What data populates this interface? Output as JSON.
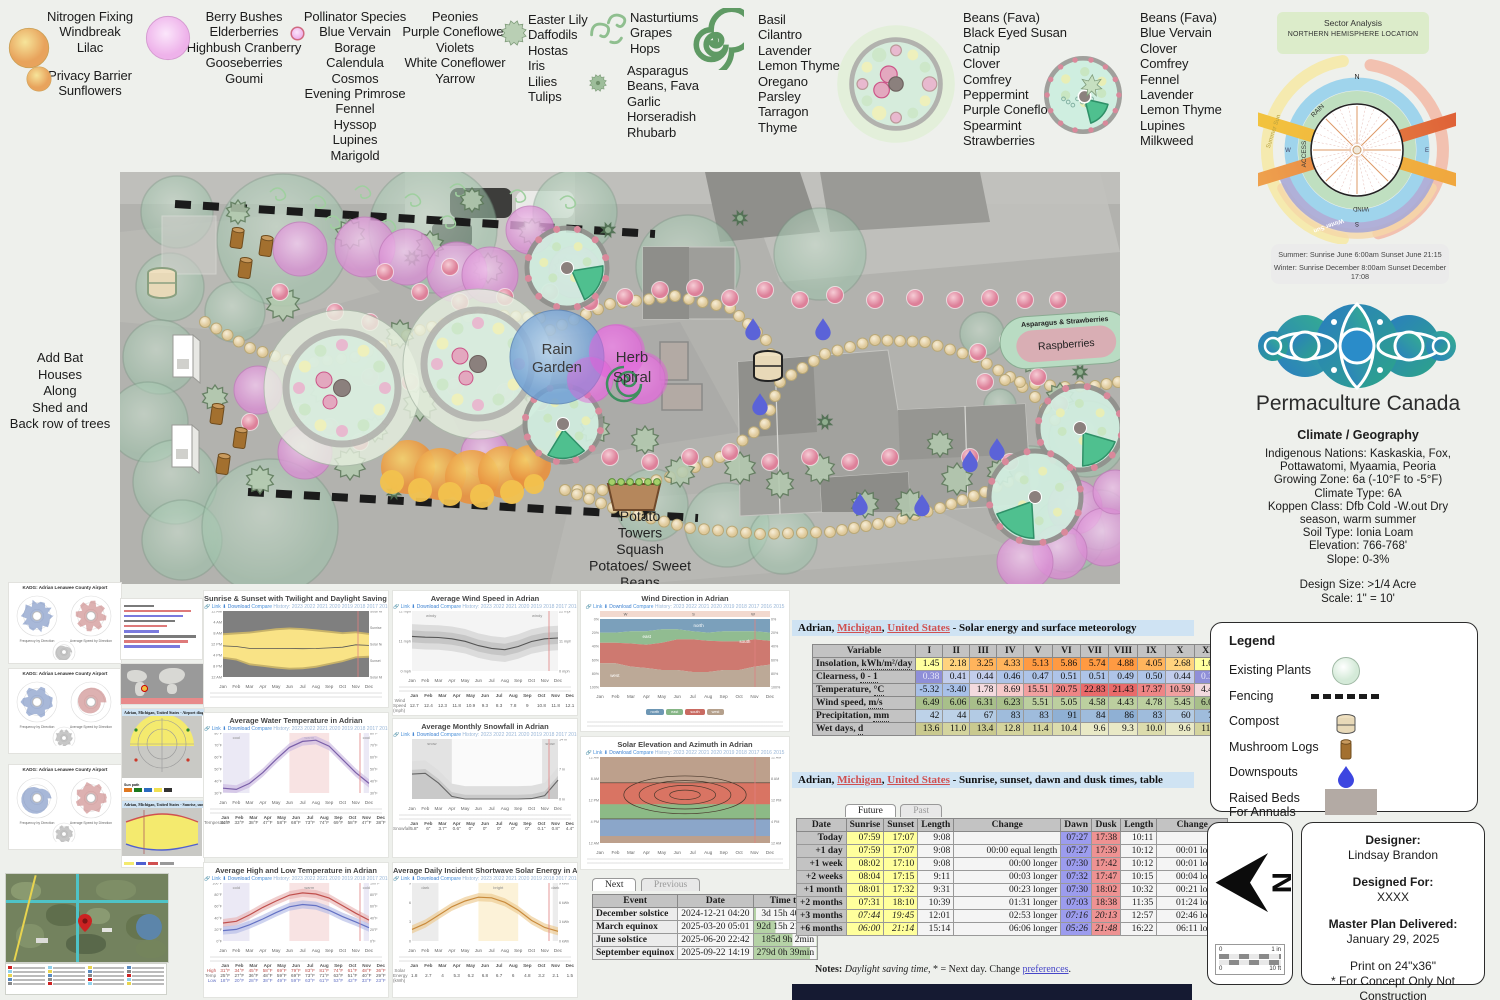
{
  "months": [
    "Jan",
    "Feb",
    "Mar",
    "Apr",
    "May",
    "Jun",
    "Jul",
    "Aug",
    "Sep",
    "Oct",
    "Nov",
    "Dec"
  ],
  "plant_legend": {
    "groups": [
      {
        "id": "nitrogen",
        "lines": [
          "Nitrogen Fixing",
          "Windbreak",
          "Lilac"
        ]
      },
      {
        "id": "privacy",
        "lines": [
          "Privacy Barrier",
          "Sunflowers"
        ]
      },
      {
        "id": "berry",
        "lines": [
          "Berry Bushes",
          "Elderberries",
          "Highbush Cranberry",
          "Gooseberries",
          "Goumi"
        ]
      },
      {
        "id": "pollinator",
        "lines": [
          "Pollinator Species",
          "Blue Vervain",
          "Borage",
          "Calendula",
          "Cosmos",
          "Evening Primrose",
          "Fennel",
          "Hyssop",
          "Lupines",
          "Marigold"
        ]
      },
      {
        "id": "peonies",
        "lines": [
          "Peonies",
          "Purple Coneflower",
          "Violets",
          "White Coneflower",
          "Yarrow"
        ]
      },
      {
        "id": "easter",
        "lines": [
          "Easter Lily",
          "Daffodils",
          "Hostas",
          "Iris",
          "Lilies",
          "Tulips"
        ]
      },
      {
        "id": "nasturtium",
        "lines": [
          "Nasturtiums",
          "Grapes",
          "Hops"
        ]
      },
      {
        "id": "asparagus",
        "lines": [
          "Asparagus",
          "Beans, Fava",
          "Garlic",
          "Horseradish",
          "Rhubarb"
        ]
      },
      {
        "id": "basil",
        "lines": [
          "Basil",
          "Cilantro",
          "Lavender",
          "Lemon Thyme",
          "Oregano",
          "Parsley",
          "Tarragon",
          "Thyme"
        ]
      },
      {
        "id": "guildL",
        "lines": [
          "Beans (Fava)",
          "Black Eyed Susan",
          "Catnip",
          "Clover",
          "Comfrey",
          "Peppermint",
          "Purple Coneflower",
          "Spearmint",
          "Strawberries"
        ]
      },
      {
        "id": "guildS",
        "lines": [
          "Beans (Fava)",
          "Blue Vervain",
          "Clover",
          "Comfrey",
          "Fennel",
          "Lavender",
          "Lemon Thyme",
          "Lupines",
          "Milkweed"
        ]
      }
    ]
  },
  "sector": {
    "title": "Sector Analysis",
    "subtitle": "NORTHERN HEMISPHERE LOCATION",
    "compass": {
      "n": "N",
      "e": "E",
      "s": "S",
      "w": "W"
    },
    "ring_labels": {
      "rain": "RAIN",
      "access": "ACCESS",
      "wind": "WIND",
      "summer": "Summer Sun",
      "winter": "Winter Sun"
    },
    "sun_line1": "Summer: Sunrise June 6:00am Sunset June 21:15",
    "sun_line2": "Winter: Sunrise December 8:00am Sunset December 17:08"
  },
  "brand": {
    "name": "Permaculture Canada"
  },
  "climate": {
    "heading": "Climate / Geography",
    "lines": [
      "Indigenous Nations: Kaskaskia, Fox,",
      "Pottawatomi, Myaamia, Peoria",
      "Growing Zone: 6a (-10°F to -5°F)",
      "Climate Type: 6A",
      "Koppen Class: Dfb Cold -W.out Dry",
      "season, warm summer",
      "Soil Type: Ionia Loam",
      "Elevation: 766-768'",
      "Slope: 0-3%"
    ],
    "design_size": "Design Size: >1/4 Acre",
    "scale": "Scale: 1\" = 10'"
  },
  "site_plan": {
    "labels": {
      "rain_garden": [
        "Rain",
        "Garden"
      ],
      "herb_spiral": [
        "Herb",
        "Spiral"
      ],
      "asparagus_strawberries": "Asparagus & Strawberries",
      "raspberries": "Raspberries",
      "potato": [
        "Potato",
        "Towers",
        "Squash",
        "Potatoes/ Sweet",
        "Beans"
      ],
      "bat_houses": [
        "Add Bat",
        "Houses",
        "Along",
        "Shed and",
        "Back row of trees"
      ]
    }
  },
  "legend_panel": {
    "title": "Legend",
    "items": [
      {
        "icon": "existing-plant",
        "label": "Existing Plants"
      },
      {
        "icon": "fencing",
        "label": "Fencing"
      },
      {
        "icon": "compost",
        "label": "Compost"
      },
      {
        "icon": "mushroom-log",
        "label": "Mushroom Logs"
      },
      {
        "icon": "downspout",
        "label": "Downspouts"
      },
      {
        "icon": "raised-bed",
        "label": "Raised Beds",
        "label2": "For Annuals"
      }
    ]
  },
  "north_scale": {
    "north": "N",
    "r1a": "0",
    "r1b": "1 in",
    "r2a": "0",
    "r2b": "10 ft"
  },
  "designer": {
    "designer_label": "Designer:",
    "designer_name": "Lindsay Brandon",
    "for_label": "Designed For:",
    "for_name": "XXXX",
    "delivered_label": "Master Plan Delivered:",
    "delivered_date": "January 29, 2025",
    "print": "Print on 24\"x36\"",
    "disclaimer": "* For Concept Only Not Construction"
  },
  "location": {
    "city": "Adrian, ",
    "state": "Michigan",
    "sep": ", ",
    "country": "United States",
    "solar_suffix": " - Solar energy and surface meteorology",
    "sun_suffix": " - Sunrise, sunset, dawn and dusk times, table",
    "airport_diag_suffix": " - Airport diagram",
    "day_graph_suffix": " - Sunrise, sunset, dawn and dusk times, graph"
  },
  "solar_table": {
    "columns": [
      "Variable",
      "I",
      "II",
      "III",
      "IV",
      "V",
      "VI",
      "VII",
      "VIII",
      "IX",
      "X",
      "XI",
      "XII"
    ],
    "rows": [
      {
        "name": "Insolation,",
        "unit": "kWh/m²/day",
        "ramp": "insolation",
        "values": [
          1.45,
          2.18,
          3.25,
          4.33,
          5.13,
          5.86,
          5.74,
          4.88,
          4.05,
          2.68,
          1.6,
          1.2
        ]
      },
      {
        "name": "Clearness,",
        "unit": "0 - 1",
        "ramp": "clearness",
        "values": [
          0.38,
          0.41,
          0.44,
          0.46,
          0.47,
          0.51,
          0.51,
          0.49,
          0.5,
          0.44,
          0.38,
          0.35
        ]
      },
      {
        "name": "Temperature,",
        "unit": "°C",
        "ramp": "temperature",
        "values": [
          -5.32,
          -3.4,
          1.78,
          8.69,
          15.51,
          20.75,
          22.83,
          21.43,
          17.37,
          10.59,
          4.49,
          -2.37
        ]
      },
      {
        "name": "Wind speed,",
        "unit": "m/s",
        "ramp": "wind",
        "values": [
          6.49,
          6.06,
          6.31,
          6.23,
          5.51,
          5.05,
          4.58,
          4.43,
          4.78,
          5.45,
          6.0,
          6.17
        ]
      },
      {
        "name": "Precipitation,",
        "unit": "mm",
        "ramp": "precip",
        "values": [
          42,
          44,
          67,
          83,
          83,
          91,
          84,
          86,
          83,
          60,
          72,
          71
        ]
      },
      {
        "name": "Wet days,",
        "unit": "d",
        "ramp": "wetdays",
        "values": [
          13.6,
          11.0,
          13.4,
          12.8,
          11.4,
          10.4,
          9.6,
          9.3,
          10.0,
          9.6,
          11.9,
          14.6
        ]
      }
    ]
  },
  "sun_table": {
    "tabs": [
      "Future",
      "Past"
    ],
    "columns": [
      "Date",
      "Sunrise",
      "Sunset",
      "Length",
      "Change",
      "Dawn",
      "Dusk",
      "Length",
      "Change"
    ],
    "rows": [
      {
        "date": "Today",
        "sunrise": "07:59",
        "sunset": "17:07",
        "len": "9:08",
        "change": "",
        "dawn": "07:27",
        "dusk": "17:38",
        "len2": "10:11",
        "change2": "",
        "italic": false
      },
      {
        "date": "+1 day",
        "sunrise": "07:59",
        "sunset": "17:07",
        "len": "9:08",
        "change": "00:00 equal length",
        "dawn": "07:27",
        "dusk": "17:39",
        "len2": "10:12",
        "change2": "00:01 longer",
        "italic": false
      },
      {
        "date": "+1 week",
        "sunrise": "08:02",
        "sunset": "17:10",
        "len": "9:08",
        "change": "00:00 longer",
        "dawn": "07:30",
        "dusk": "17:42",
        "len2": "10:12",
        "change2": "00:01 longer",
        "italic": false
      },
      {
        "date": "+2 weeks",
        "sunrise": "08:04",
        "sunset": "17:15",
        "len": "9:11",
        "change": "00:03 longer",
        "dawn": "07:32",
        "dusk": "17:47",
        "len2": "10:15",
        "change2": "00:04 longer",
        "italic": false
      },
      {
        "date": "+1 month",
        "sunrise": "08:01",
        "sunset": "17:32",
        "len": "9:31",
        "change": "00:23 longer",
        "dawn": "07:30",
        "dusk": "18:02",
        "len2": "10:32",
        "change2": "00:21 longer",
        "italic": false
      },
      {
        "date": "+2 months",
        "sunrise": "07:31",
        "sunset": "18:10",
        "len": "10:39",
        "change": "01:31 longer",
        "dawn": "07:03",
        "dusk": "18:38",
        "len2": "11:35",
        "change2": "01:24 longer",
        "italic": false
      },
      {
        "date": "+3 months",
        "sunrise": "07:44",
        "sunset": "19:45",
        "len": "12:01",
        "change": "02:53 longer",
        "dawn": "07:16",
        "dusk": "20:13",
        "len2": "12:57",
        "change2": "02:46 longer",
        "italic": true
      },
      {
        "date": "+6 months",
        "sunrise": "06:00",
        "sunset": "21:14",
        "len": "15:14",
        "change": "06:06 longer",
        "dawn": "05:26",
        "dusk": "21:48",
        "len2": "16:22",
        "change2": "06:11 longer",
        "italic": true
      }
    ],
    "notes": {
      "label": "Notes:",
      "italic_part": "Daylight saving time,",
      "mid": " * = Next day. Change ",
      "link": "preferences",
      "end": "."
    }
  },
  "events_table": {
    "tabs": [
      "Next",
      "Previous"
    ],
    "columns": [
      "Event",
      "Date",
      "Time to"
    ],
    "rows": [
      {
        "event": "December solstice",
        "date": "2024-12-21 04:20",
        "time": "3d 15h 40min",
        "pct": 4
      },
      {
        "event": "March equinox",
        "date": "2025-03-20 05:01",
        "time": "92d 15h 21min",
        "pct": 35
      },
      {
        "event": "June solstice",
        "date": "2025-06-20 22:42",
        "time": "185d 9h 2min",
        "pct": 62
      },
      {
        "event": "September equinox",
        "date": "2025-09-22 14:19",
        "time": "279d 0h 39min",
        "pct": 90
      }
    ]
  },
  "kadg": {
    "title": "KADG: Adrian Lenawee County Airport",
    "left_caption": "Frequency by Direction",
    "right_caption": "Average Speed by Direction",
    "sunpath_label": "Sun path"
  },
  "toolbar": {
    "link": "Link",
    "download": "Download",
    "compare": "Compare",
    "history": "History: 2023 2022 2021 2020 2019 2018 2017 2016 2015"
  },
  "chart_data": [
    {
      "id": "sun_times",
      "type": "area",
      "title": "Sunrise & Sunset with Twilight and Daylight Saving Time in Adrian",
      "x": "months",
      "series": [
        {
          "name": "sunrise_hour",
          "values": [
            8.1,
            7.8,
            7.5,
            6.9,
            6.3,
            6.0,
            6.2,
            6.7,
            7.2,
            7.7,
            7.4,
            8.0
          ]
        },
        {
          "name": "sunset_hour",
          "values": [
            17.3,
            18.0,
            19.7,
            20.3,
            20.9,
            21.3,
            21.2,
            20.6,
            19.6,
            18.6,
            17.2,
            17.0
          ]
        }
      ],
      "ylim": [
        0,
        24
      ],
      "y_ticks": [
        "12 AM",
        "4 AM",
        "8 AM",
        "12 PM",
        "4 PM",
        "8 PM",
        "12 AM"
      ],
      "right_labels": [
        "Solar Midnight",
        "Sunrise",
        "Solar Noon",
        "Sunset",
        "Solar Midnight"
      ]
    },
    {
      "id": "wind_speed",
      "type": "line",
      "title": "Average Wind Speed in Adrian",
      "x": "months",
      "ylabel": "mph",
      "ylim": [
        0,
        22
      ],
      "top_labels": [
        "windy",
        "windy"
      ],
      "values": [
        12.7,
        12.4,
        12.3,
        11.8,
        10.9,
        9.3,
        8.3,
        7.8,
        9.0,
        10.8,
        11.8,
        12.1
      ]
    },
    {
      "id": "wind_direction",
      "type": "area-stacked",
      "title": "Wind Direction in Adrian",
      "x": "months",
      "ylim": [
        0,
        100
      ],
      "top_band": [
        "W",
        "S",
        "W"
      ],
      "legend": [
        "north",
        "east",
        "south",
        "west"
      ],
      "series": [
        {
          "name": "north",
          "values": [
            20,
            20,
            18,
            18,
            15,
            15,
            18,
            20,
            18,
            18,
            18,
            20
          ]
        },
        {
          "name": "east",
          "values": [
            15,
            15,
            18,
            20,
            20,
            15,
            12,
            12,
            15,
            15,
            12,
            12
          ]
        },
        {
          "name": "south",
          "values": [
            30,
            30,
            34,
            34,
            40,
            45,
            48,
            46,
            42,
            42,
            40,
            35
          ]
        },
        {
          "name": "west",
          "values": [
            35,
            35,
            30,
            28,
            25,
            25,
            22,
            22,
            25,
            25,
            30,
            33
          ]
        }
      ]
    },
    {
      "id": "water_temp",
      "type": "line",
      "title": "Average Water Temperature in Adrian",
      "x": "months",
      "ylabel": "°F",
      "ylim": [
        30,
        80
      ],
      "bands": [
        "cool",
        "warm",
        "cool"
      ],
      "values": [
        34,
        33,
        38,
        47,
        58,
        68,
        73,
        74,
        69,
        58,
        47,
        38
      ]
    },
    {
      "id": "snowfall",
      "type": "area",
      "title": "Average Monthly Snowfall in Adrian",
      "x": "months",
      "ylabel": "in",
      "ylim": [
        0,
        14
      ],
      "bands": [
        "snow",
        "snow"
      ],
      "values": [
        5.8,
        6.0,
        3.7,
        0.6,
        0.0,
        0.0,
        0.0,
        0.0,
        0.0,
        0.1,
        0.8,
        4.4
      ]
    },
    {
      "id": "solar_elevation",
      "type": "contour",
      "title": "Solar Elevation and Azimuth in Adrian",
      "x": "months",
      "y_ticks": [
        "12 AM",
        "8 AM",
        "12 PM",
        "4 PM",
        "12 AM"
      ]
    },
    {
      "id": "high_low_temp",
      "type": "line",
      "title": "Average High and Low Temperature in Adrian",
      "x": "months",
      "ylabel": "°F",
      "ylim": [
        0,
        100
      ],
      "bands": [
        "cold",
        "warm",
        "cold"
      ],
      "series": [
        {
          "name": "High",
          "values": [
            31,
            34,
            45,
            58,
            69,
            79,
            83,
            81,
            74,
            61,
            48,
            36
          ]
        },
        {
          "name": "Temp",
          "values": [
            25,
            27,
            36,
            48,
            59,
            69,
            73,
            71,
            63,
            51,
            40,
            29
          ]
        },
        {
          "name": "Low",
          "values": [
            18,
            20,
            28,
            38,
            49,
            59,
            63,
            61,
            53,
            42,
            33,
            23
          ]
        }
      ]
    },
    {
      "id": "solar_energy",
      "type": "line",
      "title": "Average Daily Incident Shortwave Solar Energy in Adrian",
      "x": "months",
      "ylabel": "kWh",
      "ylim": [
        0,
        9
      ],
      "bands": [
        "dark",
        "bright",
        "dark"
      ],
      "values": [
        1.8,
        2.7,
        4.0,
        5.3,
        6.2,
        6.8,
        6.7,
        6.0,
        4.8,
        3.2,
        2.1,
        1.5
      ]
    }
  ]
}
